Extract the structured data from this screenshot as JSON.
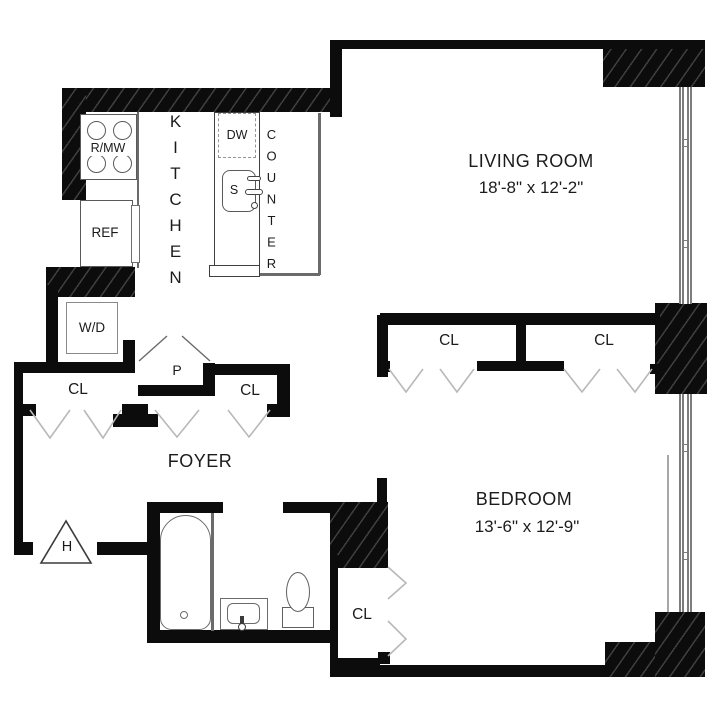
{
  "plan": {
    "living_room": {
      "label": "LIVING ROOM",
      "dimensions": "18'-8\" x 12'-2\""
    },
    "bedroom": {
      "label": "BEDROOM",
      "dimensions": "13'-6\" x 12'-9\""
    },
    "foyer": {
      "label": "FOYER"
    },
    "kitchen": {
      "label": "KITCHEN",
      "counter_label": "COUNTER"
    },
    "appliances": {
      "range_microwave": "R/MW",
      "refrigerator": "REF",
      "dishwasher": "DW",
      "sink": "S",
      "washer_dryer": "W/D"
    },
    "closets": {
      "foyer_left": "CL",
      "foyer_right": "CL",
      "pantry": "P",
      "bedroom_left": "CL",
      "bedroom_right": "CL",
      "bedroom_entry": "CL"
    },
    "heat_riser": {
      "label": "H"
    },
    "colors": {
      "wall": "#0c0c0c",
      "door_line": "#b8b8b8",
      "fixture_line": "#666666",
      "text": "#1b1b1b",
      "background": "#ffffff"
    }
  }
}
